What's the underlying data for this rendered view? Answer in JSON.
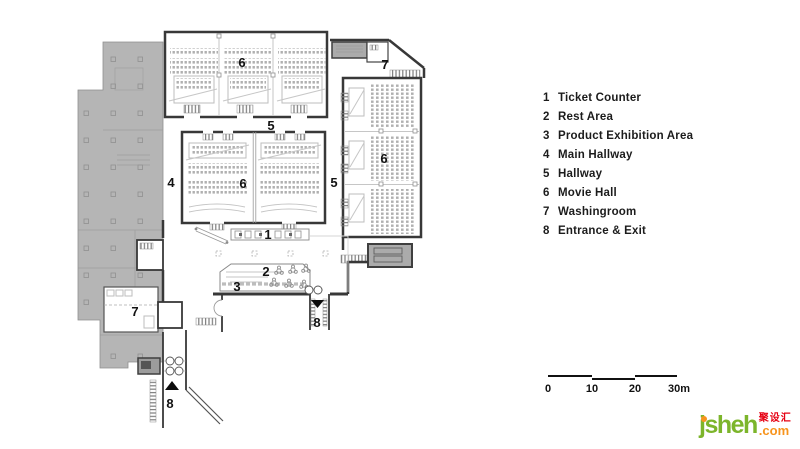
{
  "legend": {
    "items": [
      {
        "num": "1",
        "label": "Ticket Counter"
      },
      {
        "num": "2",
        "label": "Rest Area"
      },
      {
        "num": "3",
        "label": "Product Exhibition Area"
      },
      {
        "num": "4",
        "label": "Main Hallway"
      },
      {
        "num": "5",
        "label": "Hallway"
      },
      {
        "num": "6",
        "label": "Movie Hall"
      },
      {
        "num": "7",
        "label": "Washingroom"
      },
      {
        "num": "8",
        "label": "Entrance & Exit"
      }
    ]
  },
  "plan": {
    "labels": [
      {
        "text": "6",
        "area": "Movie Hall (top block)"
      },
      {
        "text": "7",
        "area": "Washingroom (top right)"
      },
      {
        "text": "5",
        "area": "Hallway (upper)"
      },
      {
        "text": "4",
        "area": "Main Hallway"
      },
      {
        "text": "6",
        "area": "Movie Hall (center block)"
      },
      {
        "text": "5",
        "area": "Hallway (right)"
      },
      {
        "text": "6",
        "area": "Movie Hall (right block)"
      },
      {
        "text": "1",
        "area": "Ticket Counter"
      },
      {
        "text": "2",
        "area": "Rest Area"
      },
      {
        "text": "3",
        "area": "Product Exhibition Area"
      },
      {
        "text": "7",
        "area": "Washingroom (left)"
      },
      {
        "text": "8",
        "area": "Entrance & Exit (right)"
      },
      {
        "text": "8",
        "area": "Entrance & Exit (bottom)"
      }
    ]
  },
  "scalebar": {
    "ticks": [
      "0",
      "10",
      "20",
      "30m"
    ]
  },
  "logo": {
    "name": "jsheh",
    "tld": ".com",
    "cjk": "聚设汇",
    "green": "#7CB52B",
    "orange": "#F7941D",
    "red": "#E60012"
  },
  "colors": {
    "building_gray": "#b5b5b5",
    "wall": "#383838",
    "seat_gray": "#b0b0b0"
  }
}
